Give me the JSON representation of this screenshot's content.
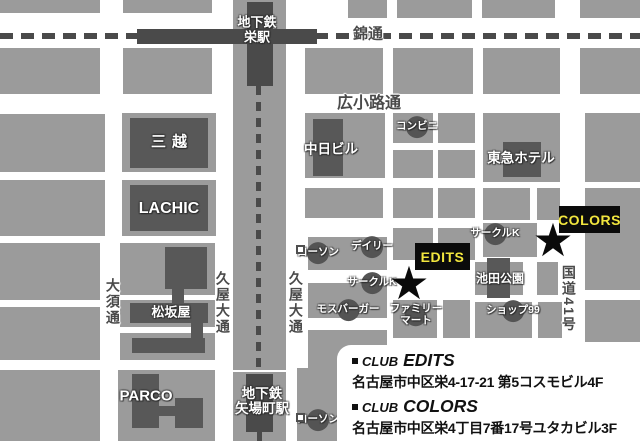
{
  "title": "CLUB EDITS / CLUB COLORS access map (Sakae, Nagoya)",
  "colors": {
    "block": "#9b9b9b",
    "building": "#585858",
    "line": "#4a4a4a",
    "venue_bg": "#0b0b0b",
    "venue_text": "#f2e63e",
    "map_label": "#ffffff",
    "street_label": "#4a4a4a",
    "background": "#ffffff"
  },
  "map": {
    "street_labels": {
      "nishiki": "錦通",
      "hirokoji": "広小路通",
      "osu": "大須通",
      "hisaya_left": "久屋大通",
      "hisaya_right": "久屋大通",
      "route41": "国道41号"
    },
    "stations": {
      "sakae": "地下鉄\n栄駅",
      "yabacho": "地下鉄\n矢場町駅"
    },
    "landmarks": {
      "mitsukoshi": "三越",
      "lachic": "LACHIC",
      "chunichi": "中日ビル",
      "tokyu": "東急ホテル",
      "matsuzakaya": "松坂屋",
      "parco": "PARCO",
      "ikeda_park": "池田公園"
    },
    "shops": {
      "conbini": "コンビニ",
      "lawson_1": "ローソン",
      "daily": "デイリー",
      "circlek_1": "サークルK",
      "circlek_2": "サークルK",
      "mos_burger": "モスバーガー",
      "family_mart": "ファミリー\nマート",
      "shop99": "ショップ99",
      "lawson_2": "ローソン"
    },
    "venues": {
      "edits": "EDITS",
      "colors": "COLORS"
    },
    "marker_glyph": "★"
  },
  "legend": {
    "items": [
      {
        "prefix": "CLUB",
        "name": "EDITS",
        "address": "名古屋市中区栄4-17-21 第5コスモビル4F"
      },
      {
        "prefix": "CLUB",
        "name": "COLORS",
        "address": "名古屋市中区栄4丁目7番17号ユタカビル3F"
      }
    ]
  }
}
